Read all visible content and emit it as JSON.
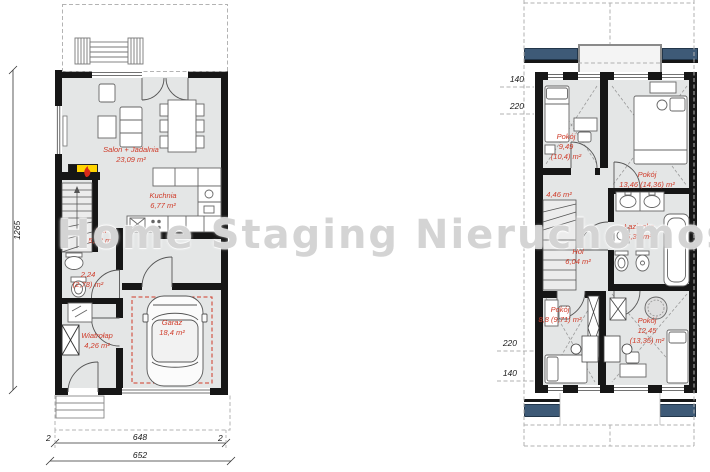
{
  "watermark": {
    "text": "Home Staging Nieruchomość"
  },
  "colors": {
    "label_red": "#cf3a28",
    "wall_black": "#161616",
    "floor_gray": "#e4e6e6",
    "window_navy": "#3e5a77",
    "garage_outline_red": "#cf3a28",
    "watermark_gray": "#d2d2d2"
  },
  "ground_floor": {
    "labels": {
      "salon": {
        "name": "Salon + Jadalnia",
        "area": "23,09 m²"
      },
      "kuchnia": {
        "name": "Kuchnia",
        "area": "6,77 m²"
      },
      "hol": {
        "name": "Hol",
        "area": "5,22 m²"
      },
      "wc": {
        "area": "2,24",
        "area_alt": "(2,78) m²"
      },
      "wiatrolap": {
        "name": "Wiatrołap",
        "area": "4,26 m²"
      },
      "garaz": {
        "name": "Garaż",
        "area": "18,4 m²"
      }
    },
    "dimensions": {
      "height": "1265",
      "width_inner": "648",
      "width_total": "652",
      "wall_left": "2",
      "wall_right": "2"
    }
  },
  "upper_floor": {
    "labels": {
      "pokoj_nw": {
        "name": "Pokój",
        "area": "9,49",
        "area_alt": "(10,4) m²"
      },
      "pokoj_ne": {
        "name": "Pokój",
        "area": "13,46 (14,36) m²"
      },
      "schody": {
        "area": "4,46 m²"
      },
      "hol": {
        "name": "Hol",
        "area": "6,04 m²"
      },
      "lazienka": {
        "name": "Łazienka",
        "area": "5,39 m²"
      },
      "pokoj_sw": {
        "name": "Pokój",
        "area": "8,8 (9,71) m²"
      },
      "pokoj_se": {
        "name": "Pokój",
        "area": "12,45",
        "area_alt": "(13,35) m²"
      }
    },
    "dimensions": {
      "top_1": "140",
      "top_2": "220",
      "bottom_1": "220",
      "bottom_2": "140"
    }
  }
}
